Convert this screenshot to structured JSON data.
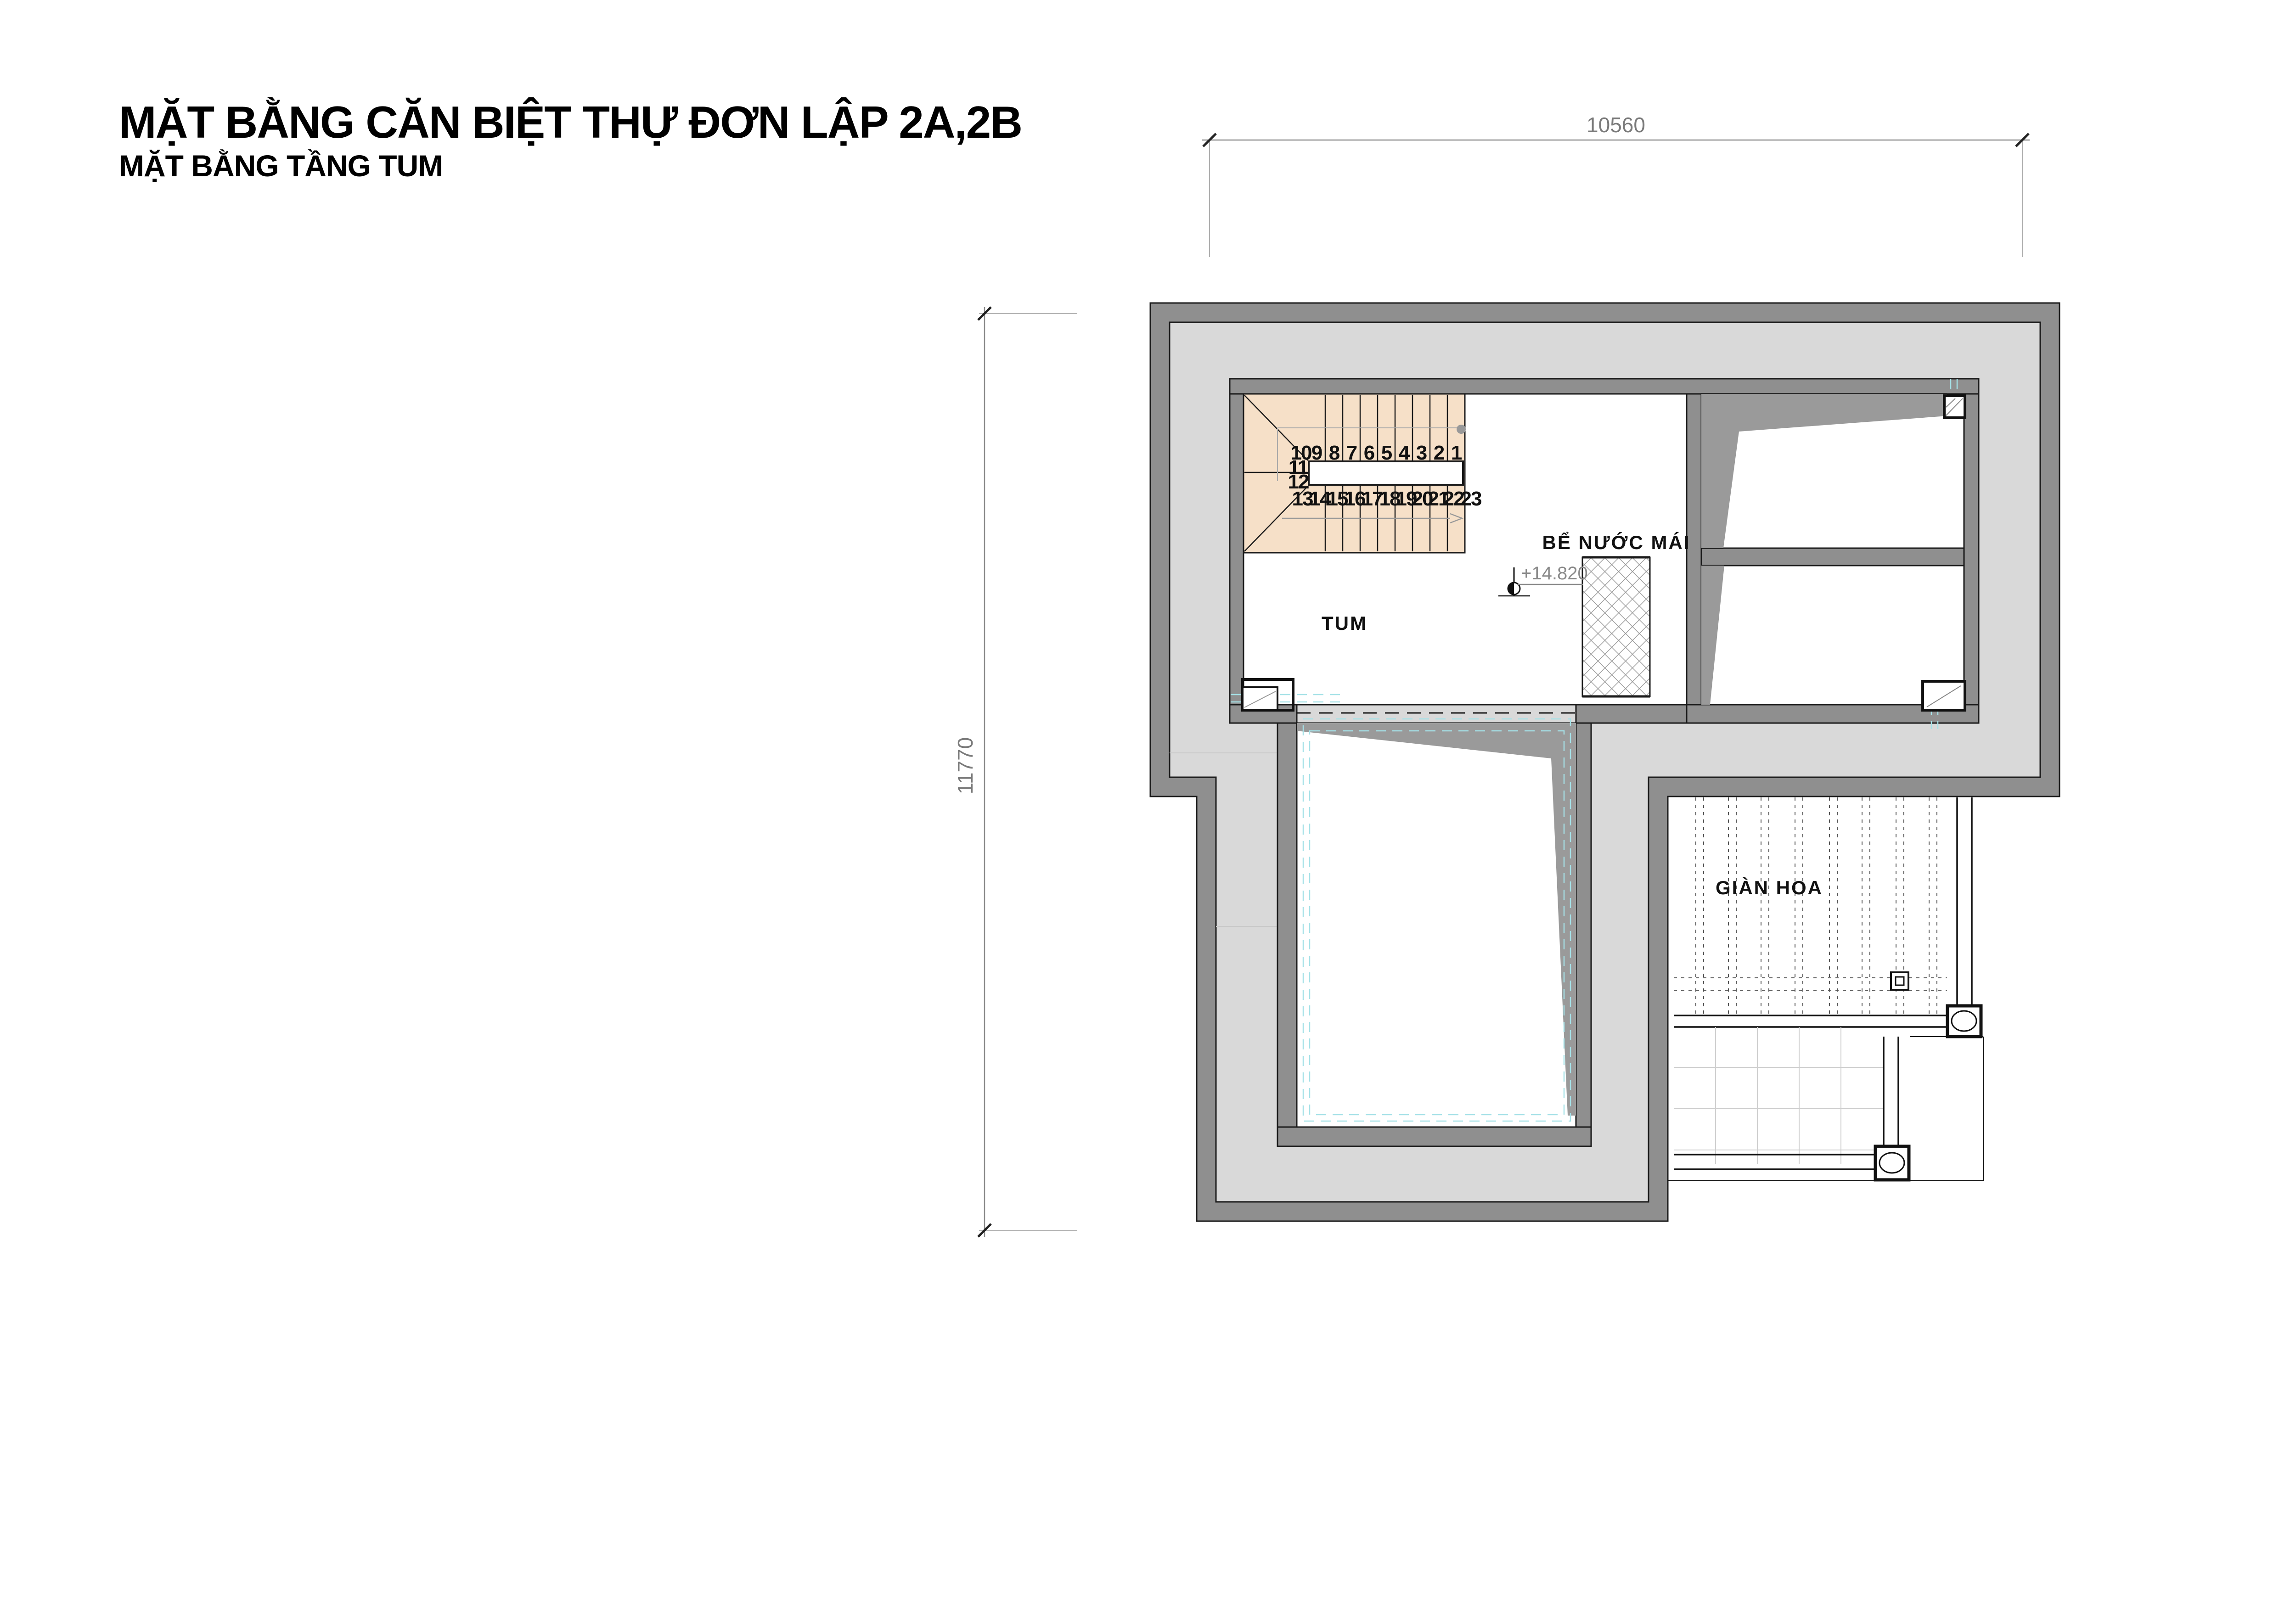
{
  "title": {
    "main": "MẶT BẰNG CĂN BIỆT THỰ ĐƠN LẬP 2A,2B",
    "subtitle": "MẶT BẰNG TẦNG TUM"
  },
  "dimensions": {
    "top": "10560",
    "left": "11770"
  },
  "plan_labels": {
    "room": "TUM",
    "water_tank": "BỂ NƯỚC MÁI",
    "pergola": "GIÀN HOA",
    "level_mark": "+14.820"
  },
  "stair": {
    "numbers": [
      "1",
      "2",
      "3",
      "4",
      "5",
      "6",
      "7",
      "8",
      "9",
      "10",
      "11",
      "12",
      "13",
      "14",
      "15",
      "16",
      "17",
      "18",
      "19",
      "20",
      "21",
      "22",
      "23"
    ]
  },
  "colors": {
    "wall_gray": "#8f8f8f",
    "roof_deck_gray": "#d9d9d9",
    "roof_slope_gray": "#9a9a9a",
    "stair_fill": "#f6e0c8",
    "outline_black": "#1a1a1a",
    "hidden_line_cyan": "#a5e1e7",
    "dimension_gray": "#7a7a7a"
  }
}
